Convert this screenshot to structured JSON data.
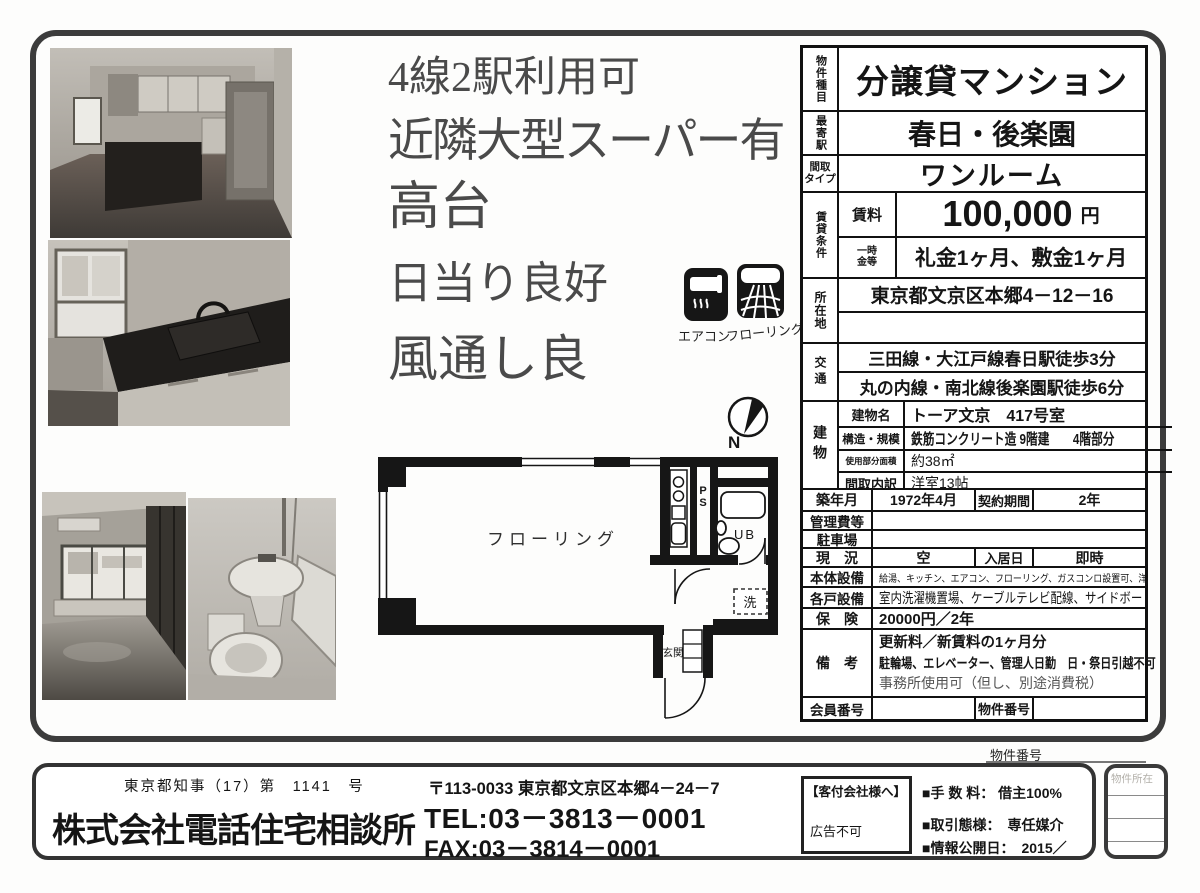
{
  "colors": {
    "ink": "#1c1c1c",
    "muted_text": "#4a4a4a",
    "frame": "#3c3c3c"
  },
  "catchphrases": [
    "4線2駅利用可",
    "近隣大型スーパー有",
    "高台",
    "日当り良好",
    "風通し良"
  ],
  "feature_icons": [
    {
      "name": "aircon-icon",
      "label": "エアコン"
    },
    {
      "name": "flooring-icon",
      "label": "フローリング"
    }
  ],
  "floorplan": {
    "room": "フローリング",
    "ps": "PS",
    "ub": "UB",
    "washer": "洗",
    "entrance": "玄関",
    "compass": "N"
  },
  "table": {
    "property_type": {
      "label": "物件種目",
      "value": "分譲貸マンション"
    },
    "nearest_station": {
      "label": "最寄駅",
      "value": "春日・後楽園"
    },
    "layout_type": {
      "label_l1": "間取",
      "label_l2": "タイプ",
      "value": "ワンルーム"
    },
    "rental_terms": {
      "label": "賃貸条件",
      "rent_label": "賃料",
      "rent_value": "100,000",
      "rent_unit": "円",
      "deposit_label_l1": "一時",
      "deposit_label_l2": "金等",
      "deposit_value": "礼金1ヶ月、敷金1ヶ月"
    },
    "location": {
      "label": "所在地",
      "value": "東京都文京区本郷4－12－16"
    },
    "access": {
      "label": "交通",
      "line1": "三田線・大江戸線春日駅徒歩3分",
      "line2": "丸の内線・南北線後楽園駅徒歩6分"
    },
    "building": {
      "label": "建物",
      "rows": [
        {
          "label": "建物名",
          "value": "トーア文京　417号室"
        },
        {
          "label": "構造・規模",
          "value": "鉄筋コンクリート造 9階建　　4階部分"
        },
        {
          "label": "使用部分面積",
          "value": "約38㎡"
        },
        {
          "label": "間取内訳",
          "value": "洋室13帖"
        }
      ]
    },
    "built": {
      "label": "築年月",
      "value": "1972年4月",
      "contract_label": "契約期間",
      "contract_value": "2年"
    },
    "management_fee": {
      "label": "管理費等",
      "value": ""
    },
    "parking": {
      "label": "駐車場",
      "value": ""
    },
    "status": {
      "label": "現　況",
      "value": "空",
      "movein_label": "入居日",
      "movein_value": "即時"
    },
    "main_equipment": {
      "label": "本体設備",
      "value": "給湯、キッチン、エアコン、フローリング、ガスコンロ設置可、洋服ダンス"
    },
    "unit_equipment": {
      "label": "各戸設備",
      "value": "室内洗濯機置場、ケーブルテレビ配線、サイドボード"
    },
    "insurance": {
      "label": "保　険",
      "value": "20000円／2年"
    },
    "notes": {
      "label": "備　考",
      "line1": "更新料／新賃料の1ヶ月分",
      "line2": "駐輪場、エレベーター、管理人日勤　日・祭日引越不可",
      "line3": "事務所使用可（但し、別途消費税）"
    },
    "member_no": {
      "label": "会員番号",
      "value": ""
    },
    "property_no": {
      "label": "物件番号",
      "value": ""
    }
  },
  "property_no_caption": "物件番号",
  "footer": {
    "license": "東京都知事（17）第　1141　号",
    "company": "株式会社電話住宅相談所",
    "address": "〒113-0033 東京都文京区本郷4－24－7",
    "tel": "TEL:03－3813－0001",
    "fax": "FAX:03－3814－0001",
    "agent_box_title": "【客付会社様へ】",
    "agent_box_note": "広告不可",
    "fee": "■手 数 料： 借主100%",
    "transaction": "■取引態様：　専任媒介",
    "publish_date": "■情報公開日：　2015／",
    "side_box_label": "物件所在"
  }
}
